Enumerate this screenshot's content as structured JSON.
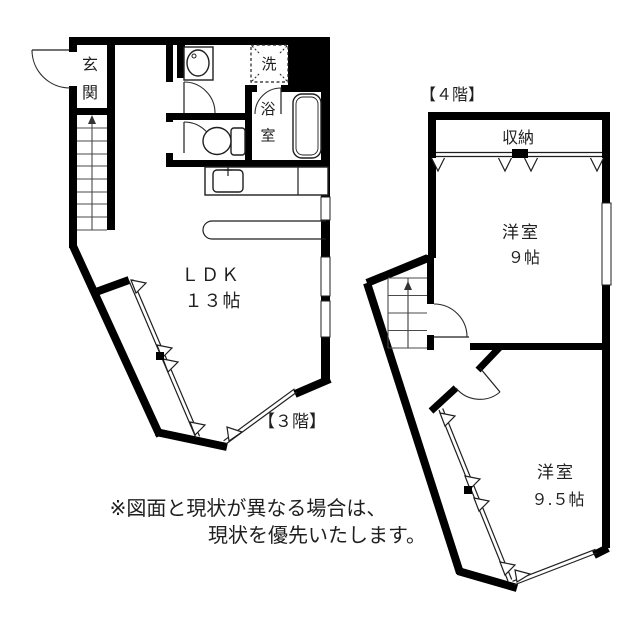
{
  "colors": {
    "wall": "#000000",
    "line": "#1f1f1f",
    "background": "#ffffff"
  },
  "floor3": {
    "floor_label": "【３階】",
    "entrance": "玄関",
    "washer": "洗",
    "bathroom": "浴室",
    "ldk_name": "ＬＤＫ",
    "ldk_size": "１３帖"
  },
  "floor4": {
    "floor_label": "【４階】",
    "storage": "収納",
    "room9_name": "洋室",
    "room9_size": "９帖",
    "room95_name": "洋室",
    "room95_size": "９.５帖"
  },
  "note": {
    "line1": "※図面と現状が異なる場合は、",
    "line2": "現状を優先いたします。"
  }
}
